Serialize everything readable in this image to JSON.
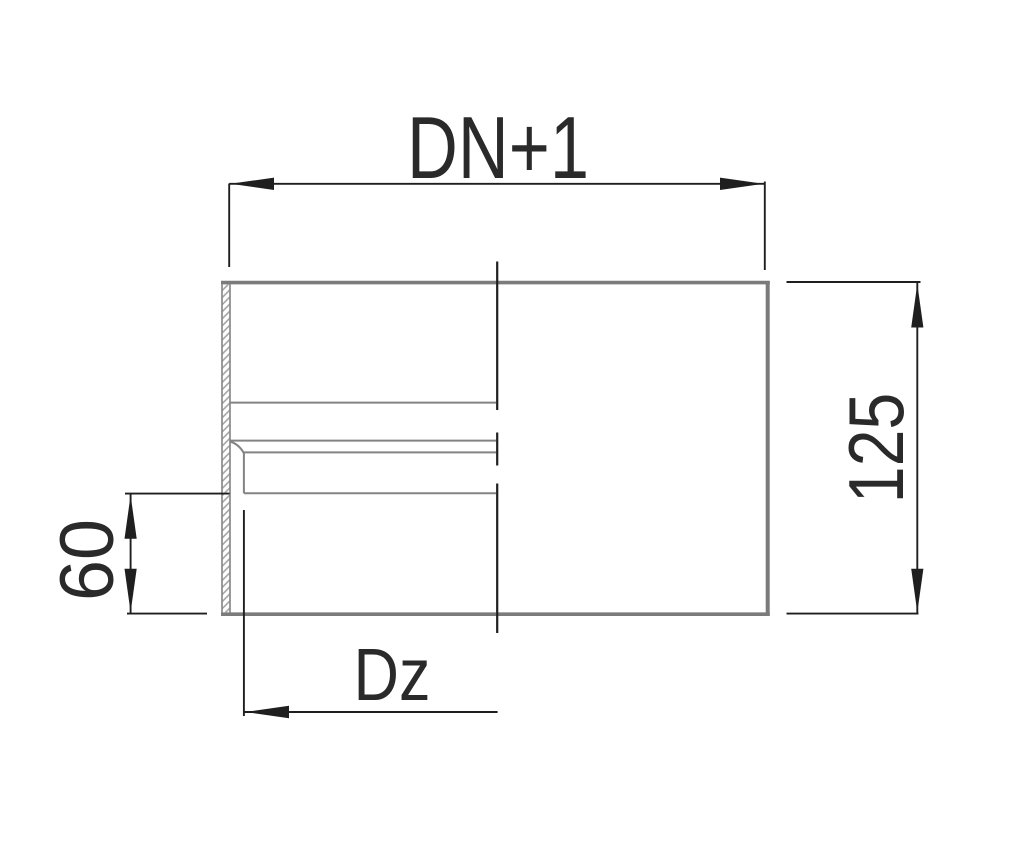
{
  "drawing": {
    "kind": "technical-dimension-drawing",
    "dimension_labels": {
      "overall_width": "DN+1",
      "overall_height": "125",
      "socket_depth": "60",
      "inner_diameter": "Dz"
    }
  },
  "colors": {
    "background": "#ffffff",
    "object-line": "#7b7b7b",
    "object-line-thin": "#838383",
    "hatch-line": "#9e9e9e",
    "dimension-line": "#1f1f1f",
    "text": "#2a2a2a"
  }
}
